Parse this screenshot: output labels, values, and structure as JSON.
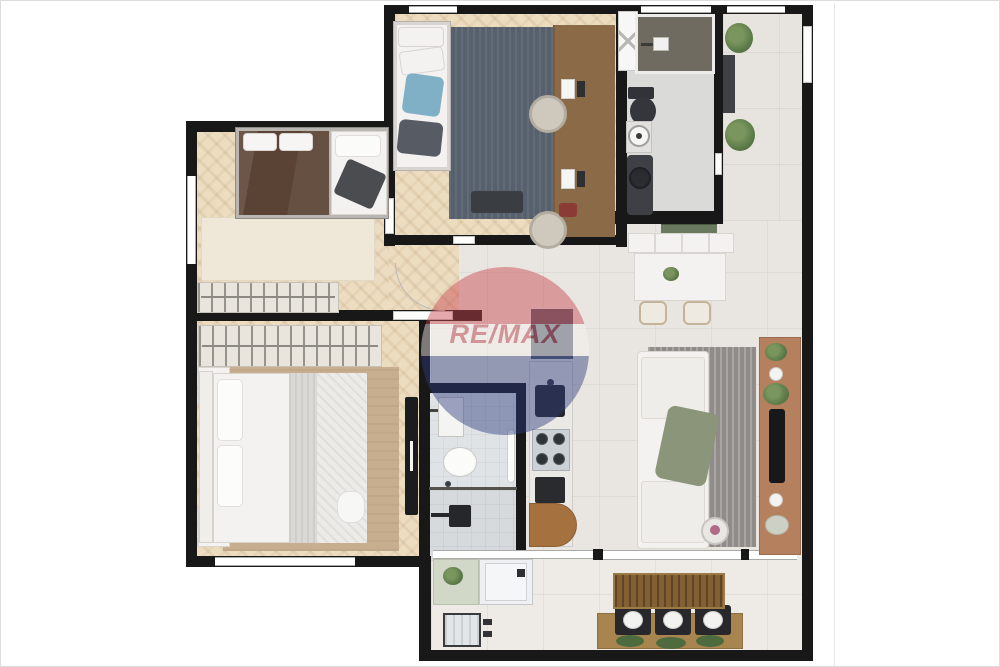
{
  "watermark": {
    "brand_text": "RE/MAX"
  },
  "palette": {
    "page_bg": "#ffffff",
    "canvas_border": "#dcdcdc",
    "wall": "#181818",
    "wood_floor": "#ecddc1",
    "tile_floor": "#e9e6e1",
    "entry_tile": "#e7e4df",
    "bath_floor": "#dadad8",
    "ensuite_tile": "#e0e3e6",
    "shower_dark": "#6f6b61",
    "office_rug": "#57606d",
    "living_rug": "#8f8c89",
    "bedroom1_rug": "#c7ae8e",
    "bedroom2_rug": "#efe8d9",
    "desk_wood": "#8b6a48",
    "tv_console_wood": "#b5805d",
    "balcony_wood": "#826034",
    "bench_wood": "#a8854f",
    "dark_fixture": "#2c2d31",
    "appliance_dark": "#57606e",
    "white_furniture": "#f3f2f0",
    "throw_green": "#8a9579",
    "plant_green": "#5e7d4a",
    "service_counter_green": "#d2d8c8",
    "balloon_red": "#c9424d",
    "balloon_blue": "#2c3a7d",
    "balloon_text_red": "#b5323e"
  },
  "rooms": [
    "home-office-guest-room",
    "social-bathroom",
    "entry-hall",
    "bedroom-2",
    "master-bedroom",
    "ensuite-bathroom",
    "kitchen",
    "living-dining-room",
    "service-area",
    "gourmet-balcony"
  ],
  "furniture_legend": [
    "single-bed",
    "office-desk",
    "desk-chair",
    "shower",
    "toilet",
    "round-sink",
    "vanity",
    "linen-cabinet",
    "plant",
    "double-bed",
    "wardrobe-hangers",
    "nightstand-lamp",
    "tv-panel",
    "dining-table",
    "dining-chair",
    "sofa",
    "green-throw",
    "side-table",
    "tv-console",
    "refrigerator",
    "kitchen-sink",
    "cooktop-4-burners",
    "oven",
    "washing-machine",
    "laundry-tank",
    "bar-table",
    "stool-with-plate",
    "rug"
  ]
}
